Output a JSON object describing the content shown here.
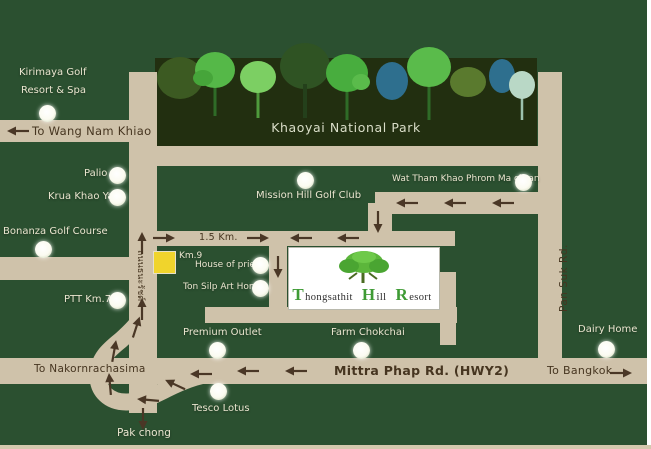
{
  "colors": {
    "background": "#2b5030",
    "road": "#cfc2aa",
    "park_banner": "#222f10",
    "arrow": "#4a3726",
    "label_light": "#eae5cf",
    "road_text_dark": "#463520",
    "km9_square": "#f0d42c",
    "resort_accent_green": "#3f9b35",
    "marker_white": "#ffffff"
  },
  "park": {
    "title": "Khaoyai National Park"
  },
  "roads": {
    "wang_nam_khiao": "To Wang Nam Khiao",
    "distance": "1.5 Km.",
    "km9": "Km.9",
    "mittra_phap": "Mittra Phap Rd. (HWY2)",
    "to_bangkok": "To Bangkok",
    "to_nakornrachasima": "To Nakornrachasima",
    "pan_suk": "Pan Suk Rd.",
    "thanarat": "ถนนธนะรัชต์",
    "pak_chong": "Pak chong"
  },
  "locations": {
    "kirimaya_line1": "Kirimaya Golf",
    "kirimaya_line2": "Resort & Spa",
    "palio": "Palio",
    "krua_khao_yai": "Krua Khao Yai",
    "bonanza": "Bonanza Golf Course",
    "ptt": "PTT Km.7",
    "mission_hill": "Mission Hill Golf Club",
    "wat_tham": "Wat Tham Khao Phrom Ma chran",
    "house_of_priest": "House of priest",
    "ton_silp": "Ton Silp Art Home",
    "premium_outlet": "Premium Outlet",
    "farm_chokchai": "Farm Chokchai",
    "tesco_lotus": "Tesco Lotus",
    "dairy_home": "Dairy Home"
  },
  "resort": {
    "words": [
      {
        "cap": "T",
        "rest": "hongsathit"
      },
      {
        "cap": "H",
        "rest": "ill"
      },
      {
        "cap": "R",
        "rest": "esort"
      }
    ]
  }
}
